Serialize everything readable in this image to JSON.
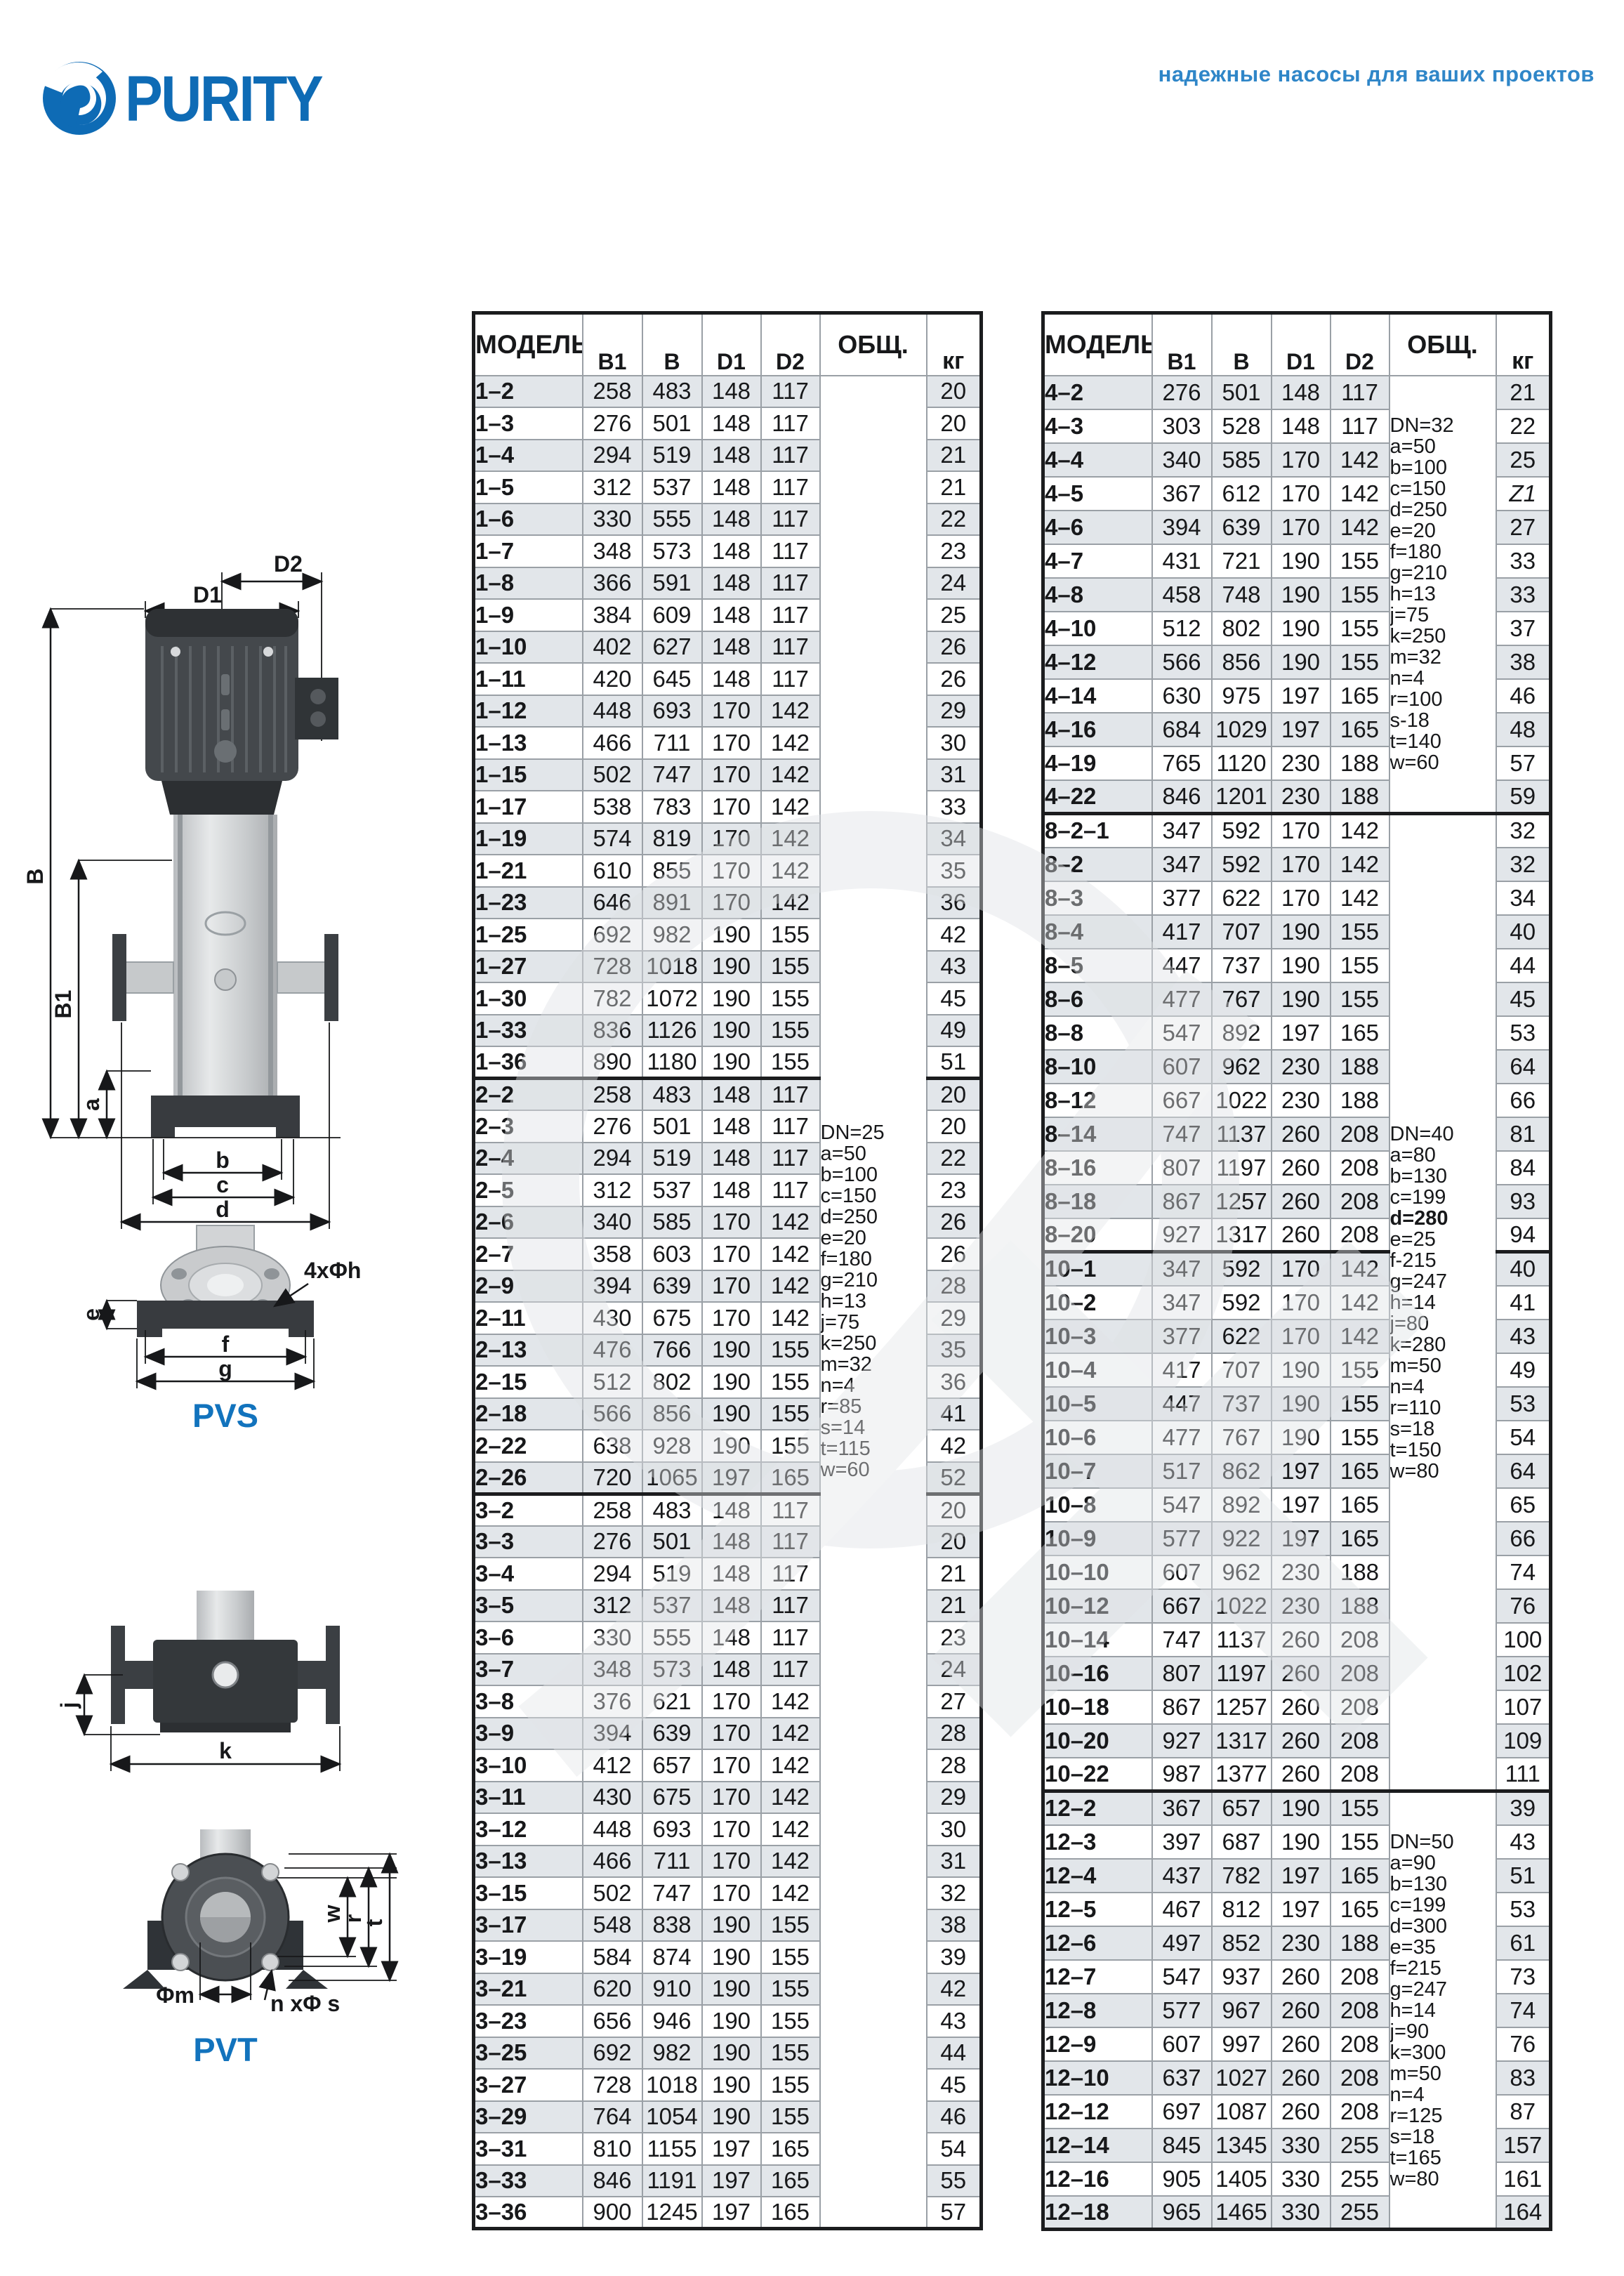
{
  "header": {
    "logo_text": "PURITY",
    "tagline": "надежные насосы для ваших проектов"
  },
  "drawings": {
    "pvs_label": "PVS",
    "pvt_label": "PVT",
    "d1": "D1",
    "d2": "D2",
    "b_cap": "B",
    "b1": "B1",
    "a": "a",
    "b": "b",
    "c": "c",
    "d": "d",
    "e": "e",
    "f": "f",
    "g": "g",
    "holes4": "4xΦh",
    "j": "j",
    "k": "k",
    "w": "w",
    "r": "r",
    "t": "t",
    "phim": "Φm",
    "nphis": "n xΦ s"
  },
  "left_table": {
    "columns": [
      "МОДЕЛЬ",
      "B1",
      "B",
      "D1",
      "D2",
      "ОБЩ.",
      "кг"
    ],
    "notes_cells": [
      {
        "group": 0,
        "row": 0,
        "rowspan": 58,
        "block": 0
      }
    ],
    "notes_blocks": [
      {
        "lines": [
          "DN=25",
          "a=50",
          "b=100",
          "c=150",
          "d=250",
          "e=20",
          "f=180",
          "g=210",
          "h=13",
          "j=75",
          "k=250",
          "m=32",
          "n=4",
          "r=85",
          "s=14",
          "t=115",
          "w=60"
        ],
        "bold": []
      }
    ],
    "groups": [
      {
        "rows": [
          [
            "1–2",
            "258",
            "483",
            "148",
            "117",
            "20"
          ],
          [
            "1–3",
            "276",
            "501",
            "148",
            "117",
            "20"
          ],
          [
            "1–4",
            "294",
            "519",
            "148",
            "117",
            "21"
          ],
          [
            "1–5",
            "312",
            "537",
            "148",
            "117",
            "21"
          ],
          [
            "1–6",
            "330",
            "555",
            "148",
            "117",
            "22"
          ],
          [
            "1–7",
            "348",
            "573",
            "148",
            "117",
            "23"
          ],
          [
            "1–8",
            "366",
            "591",
            "148",
            "117",
            "24"
          ],
          [
            "1–9",
            "384",
            "609",
            "148",
            "117",
            "25"
          ],
          [
            "1–10",
            "402",
            "627",
            "148",
            "117",
            "26"
          ],
          [
            "1–11",
            "420",
            "645",
            "148",
            "117",
            "26"
          ],
          [
            "1–12",
            "448",
            "693",
            "170",
            "142",
            "29"
          ],
          [
            "1–13",
            "466",
            "711",
            "170",
            "142",
            "30"
          ],
          [
            "1–15",
            "502",
            "747",
            "170",
            "142",
            "31"
          ],
          [
            "1–17",
            "538",
            "783",
            "170",
            "142",
            "33"
          ],
          [
            "1–19",
            "574",
            "819",
            "170",
            "142",
            "34"
          ],
          [
            "1–21",
            "610",
            "855",
            "170",
            "142",
            "35"
          ],
          [
            "1–23",
            "646",
            "891",
            "170",
            "142",
            "36"
          ],
          [
            "1–25",
            "692",
            "982",
            "190",
            "155",
            "42"
          ],
          [
            "1–27",
            "728",
            "1018",
            "190",
            "155",
            "43"
          ],
          [
            "1–30",
            "782",
            "1072",
            "190",
            "155",
            "45"
          ],
          [
            "1–33",
            "836",
            "1126",
            "190",
            "155",
            "49"
          ],
          [
            "1–36",
            "890",
            "1180",
            "190",
            "155",
            "51"
          ]
        ]
      },
      {
        "rows": [
          [
            "2–2",
            "258",
            "483",
            "148",
            "117",
            "20"
          ],
          [
            "2–3",
            "276",
            "501",
            "148",
            "117",
            "20"
          ],
          [
            "2–4",
            "294",
            "519",
            "148",
            "117",
            "22"
          ],
          [
            "2–5",
            "312",
            "537",
            "148",
            "117",
            "23"
          ],
          [
            "2–6",
            "340",
            "585",
            "170",
            "142",
            "26"
          ],
          [
            "2–7",
            "358",
            "603",
            "170",
            "142",
            "26"
          ],
          [
            "2–9",
            "394",
            "639",
            "170",
            "142",
            "28"
          ],
          [
            "2–11",
            "430",
            "675",
            "170",
            "142",
            "29"
          ],
          [
            "2–13",
            "476",
            "766",
            "190",
            "155",
            "35"
          ],
          [
            "2–15",
            "512",
            "802",
            "190",
            "155",
            "36"
          ],
          [
            "2–18",
            "566",
            "856",
            "190",
            "155",
            "41"
          ],
          [
            "2–22",
            "638",
            "928",
            "190",
            "155",
            "42"
          ],
          [
            "2–26",
            "720",
            "1065",
            "197",
            "165",
            "52"
          ]
        ]
      },
      {
        "rows": [
          [
            "3–2",
            "258",
            "483",
            "148",
            "117",
            "20"
          ],
          [
            "3–3",
            "276",
            "501",
            "148",
            "117",
            "20"
          ],
          [
            "3–4",
            "294",
            "519",
            "148",
            "117",
            "21"
          ],
          [
            "3–5",
            "312",
            "537",
            "148",
            "117",
            "21"
          ],
          [
            "3–6",
            "330",
            "555",
            "148",
            "117",
            "23"
          ],
          [
            "3–7",
            "348",
            "573",
            "148",
            "117",
            "24"
          ],
          [
            "3–8",
            "376",
            "621",
            "170",
            "142",
            "27"
          ],
          [
            "3–9",
            "394",
            "639",
            "170",
            "142",
            "28"
          ],
          [
            "3–10",
            "412",
            "657",
            "170",
            "142",
            "28"
          ],
          [
            "3–11",
            "430",
            "675",
            "170",
            "142",
            "29"
          ],
          [
            "3–12",
            "448",
            "693",
            "170",
            "142",
            "30"
          ],
          [
            "3–13",
            "466",
            "711",
            "170",
            "142",
            "31"
          ],
          [
            "3–15",
            "502",
            "747",
            "170",
            "142",
            "32"
          ],
          [
            "3–17",
            "548",
            "838",
            "190",
            "155",
            "38"
          ],
          [
            "3–19",
            "584",
            "874",
            "190",
            "155",
            "39"
          ],
          [
            "3–21",
            "620",
            "910",
            "190",
            "155",
            "42"
          ],
          [
            "3–23",
            "656",
            "946",
            "190",
            "155",
            "43"
          ],
          [
            "3–25",
            "692",
            "982",
            "190",
            "155",
            "44"
          ],
          [
            "3–27",
            "728",
            "1018",
            "190",
            "155",
            "45"
          ],
          [
            "3–29",
            "764",
            "1054",
            "190",
            "155",
            "46"
          ],
          [
            "3–31",
            "810",
            "1155",
            "197",
            "165",
            "54"
          ],
          [
            "3–33",
            "846",
            "1191",
            "197",
            "165",
            "55"
          ],
          [
            "3–36",
            "900",
            "1245",
            "197",
            "165",
            "57"
          ]
        ]
      }
    ]
  },
  "right_table": {
    "columns": [
      "МОДЕЛЬ",
      "B1",
      "B",
      "D1",
      "D2",
      "ОБЩ.",
      "кг"
    ],
    "notes_cells": [
      {
        "group": 0,
        "row": 0,
        "rowspan": 13,
        "block": 0
      },
      {
        "group": 1,
        "row": 0,
        "rowspan": 29,
        "block": 1
      },
      {
        "group": 3,
        "row": 0,
        "rowspan": 13,
        "block": 2
      }
    ],
    "notes_blocks": [
      {
        "lines": [
          "DN=32",
          "a=50",
          "b=100",
          "c=150",
          "d=250",
          "e=20",
          "f=180",
          "g=210",
          "h=13",
          "j=75",
          "k=250",
          "m=32",
          "n=4",
          "r=100",
          "s-18",
          "t=140",
          "w=60"
        ],
        "bold": []
      },
      {
        "lines": [
          "DN=40",
          "a=80",
          "b=130",
          "c=199",
          "d=280",
          "e=25",
          "f-215",
          "g=247",
          "h=14",
          "j=80",
          "k=280",
          "m=50",
          "n=4",
          "r=110",
          "s=18",
          "t=150",
          "w=80"
        ],
        "bold": [
          "d=280"
        ]
      },
      {
        "lines": [
          "DN=50",
          "a=90",
          "b=130",
          "c=199",
          "d=300",
          "e=35",
          "f=215",
          "g=247",
          "h=14",
          "j=90",
          "k=300",
          "m=50",
          "n=4",
          "r=125",
          "s=18",
          "t=165",
          "w=80"
        ],
        "bold": []
      }
    ],
    "groups": [
      {
        "rows": [
          [
            "4–2",
            "276",
            "501",
            "148",
            "117",
            "21"
          ],
          [
            "4–3",
            "303",
            "528",
            "148",
            "117",
            "22"
          ],
          [
            "4–4",
            "340",
            "585",
            "170",
            "142",
            "25"
          ],
          [
            "4–5",
            "367",
            "612",
            "170",
            "142",
            "Z1"
          ],
          [
            "4–6",
            "394",
            "639",
            "170",
            "142",
            "27"
          ],
          [
            "4–7",
            "431",
            "721",
            "190",
            "155",
            "33"
          ],
          [
            "4–8",
            "458",
            "748",
            "190",
            "155",
            "33"
          ],
          [
            "4–10",
            "512",
            "802",
            "190",
            "155",
            "37"
          ],
          [
            "4–12",
            "566",
            "856",
            "190",
            "155",
            "38"
          ],
          [
            "4–14",
            "630",
            "975",
            "197",
            "165",
            "46"
          ],
          [
            "4–16",
            "684",
            "1029",
            "197",
            "165",
            "48"
          ],
          [
            "4–19",
            "765",
            "1120",
            "230",
            "188",
            "57"
          ],
          [
            "4–22",
            "846",
            "1201",
            "230",
            "188",
            "59"
          ]
        ]
      },
      {
        "rows": [
          [
            "8–2–1",
            "347",
            "592",
            "170",
            "142",
            "32"
          ],
          [
            "8–2",
            "347",
            "592",
            "170",
            "142",
            "32"
          ],
          [
            "8–3",
            "377",
            "622",
            "170",
            "142",
            "34"
          ],
          [
            "8–4",
            "417",
            "707",
            "190",
            "155",
            "40"
          ],
          [
            "8–5",
            "447",
            "737",
            "190",
            "155",
            "44"
          ],
          [
            "8–6",
            "477",
            "767",
            "190",
            "155",
            "45"
          ],
          [
            "8–8",
            "547",
            "892",
            "197",
            "165",
            "53"
          ],
          [
            "8–10",
            "607",
            "962",
            "230",
            "188",
            "64"
          ],
          [
            "8–12",
            "667",
            "1022",
            "230",
            "188",
            "66"
          ],
          [
            "8–14",
            "747",
            "1137",
            "260",
            "208",
            "81"
          ],
          [
            "8–16",
            "807",
            "1197",
            "260",
            "208",
            "84"
          ],
          [
            "8–18",
            "867",
            "1257",
            "260",
            "208",
            "93"
          ],
          [
            "8–20",
            "927",
            "1317",
            "260",
            "208",
            "94"
          ]
        ]
      },
      {
        "rows": [
          [
            "10–1",
            "347",
            "592",
            "170",
            "142",
            "40"
          ],
          [
            "10–2",
            "347",
            "592",
            "170",
            "142",
            "41"
          ],
          [
            "10–3",
            "377",
            "622",
            "170",
            "142",
            "43"
          ],
          [
            "10–4",
            "417",
            "707",
            "190",
            "155",
            "49"
          ],
          [
            "10–5",
            "447",
            "737",
            "190",
            "155",
            "53"
          ],
          [
            "10–6",
            "477",
            "767",
            "190",
            "155",
            "54"
          ],
          [
            "10–7",
            "517",
            "862",
            "197",
            "165",
            "64"
          ],
          [
            "10–8",
            "547",
            "892",
            "197",
            "165",
            "65"
          ],
          [
            "10–9",
            "577",
            "922",
            "197",
            "165",
            "66"
          ],
          [
            "10–10",
            "607",
            "962",
            "230",
            "188",
            "74"
          ],
          [
            "10–12",
            "667",
            "1022",
            "230",
            "188",
            "76"
          ],
          [
            "10–14",
            "747",
            "1137",
            "260",
            "208",
            "100"
          ],
          [
            "10–16",
            "807",
            "1197",
            "260",
            "208",
            "102"
          ],
          [
            "10–18",
            "867",
            "1257",
            "260",
            "208",
            "107"
          ],
          [
            "10–20",
            "927",
            "1317",
            "260",
            "208",
            "109"
          ],
          [
            "10–22",
            "987",
            "1377",
            "260",
            "208",
            "111"
          ]
        ]
      },
      {
        "rows": [
          [
            "12–2",
            "367",
            "657",
            "190",
            "155",
            "39"
          ],
          [
            "12–3",
            "397",
            "687",
            "190",
            "155",
            "43"
          ],
          [
            "12–4",
            "437",
            "782",
            "197",
            "165",
            "51"
          ],
          [
            "12–5",
            "467",
            "812",
            "197",
            "165",
            "53"
          ],
          [
            "12–6",
            "497",
            "852",
            "230",
            "188",
            "61"
          ],
          [
            "12–7",
            "547",
            "937",
            "260",
            "208",
            "73"
          ],
          [
            "12–8",
            "577",
            "967",
            "260",
            "208",
            "74"
          ],
          [
            "12–9",
            "607",
            "997",
            "260",
            "208",
            "76"
          ],
          [
            "12–10",
            "637",
            "1027",
            "260",
            "208",
            "83"
          ],
          [
            "12–12",
            "697",
            "1087",
            "260",
            "208",
            "87"
          ],
          [
            "12–14",
            "845",
            "1345",
            "330",
            "255",
            "157"
          ],
          [
            "12–16",
            "905",
            "1405",
            "330",
            "255",
            "161"
          ],
          [
            "12–18",
            "965",
            "1465",
            "330",
            "255",
            "164"
          ]
        ]
      }
    ]
  }
}
